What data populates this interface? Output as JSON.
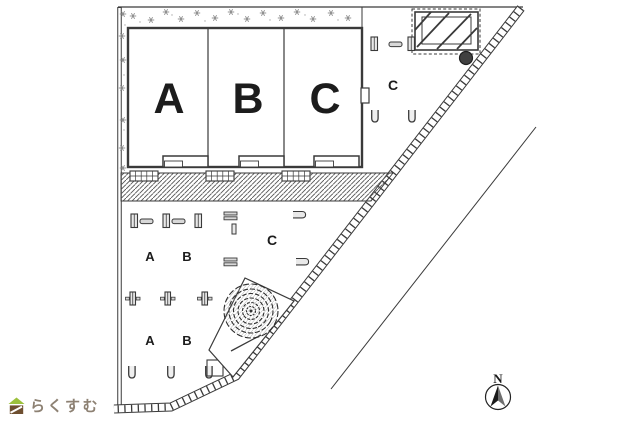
{
  "site_plan": {
    "unit_labels": [
      "A",
      "B",
      "C"
    ],
    "parking": {
      "upper_zone_label": "C",
      "mid_zone_label": "C",
      "row1": [
        "A",
        "B"
      ],
      "row2": [
        "A",
        "B"
      ]
    },
    "compass": {
      "north_label": "N"
    },
    "colors": {
      "line": "#3a3a3a",
      "hatch": "#555555"
    }
  },
  "branding": {
    "logo_text": "らくすむ",
    "logo_green": "#9cc13c",
    "logo_brown": "#6e4f30",
    "logo_text_color": "#8d8173"
  }
}
